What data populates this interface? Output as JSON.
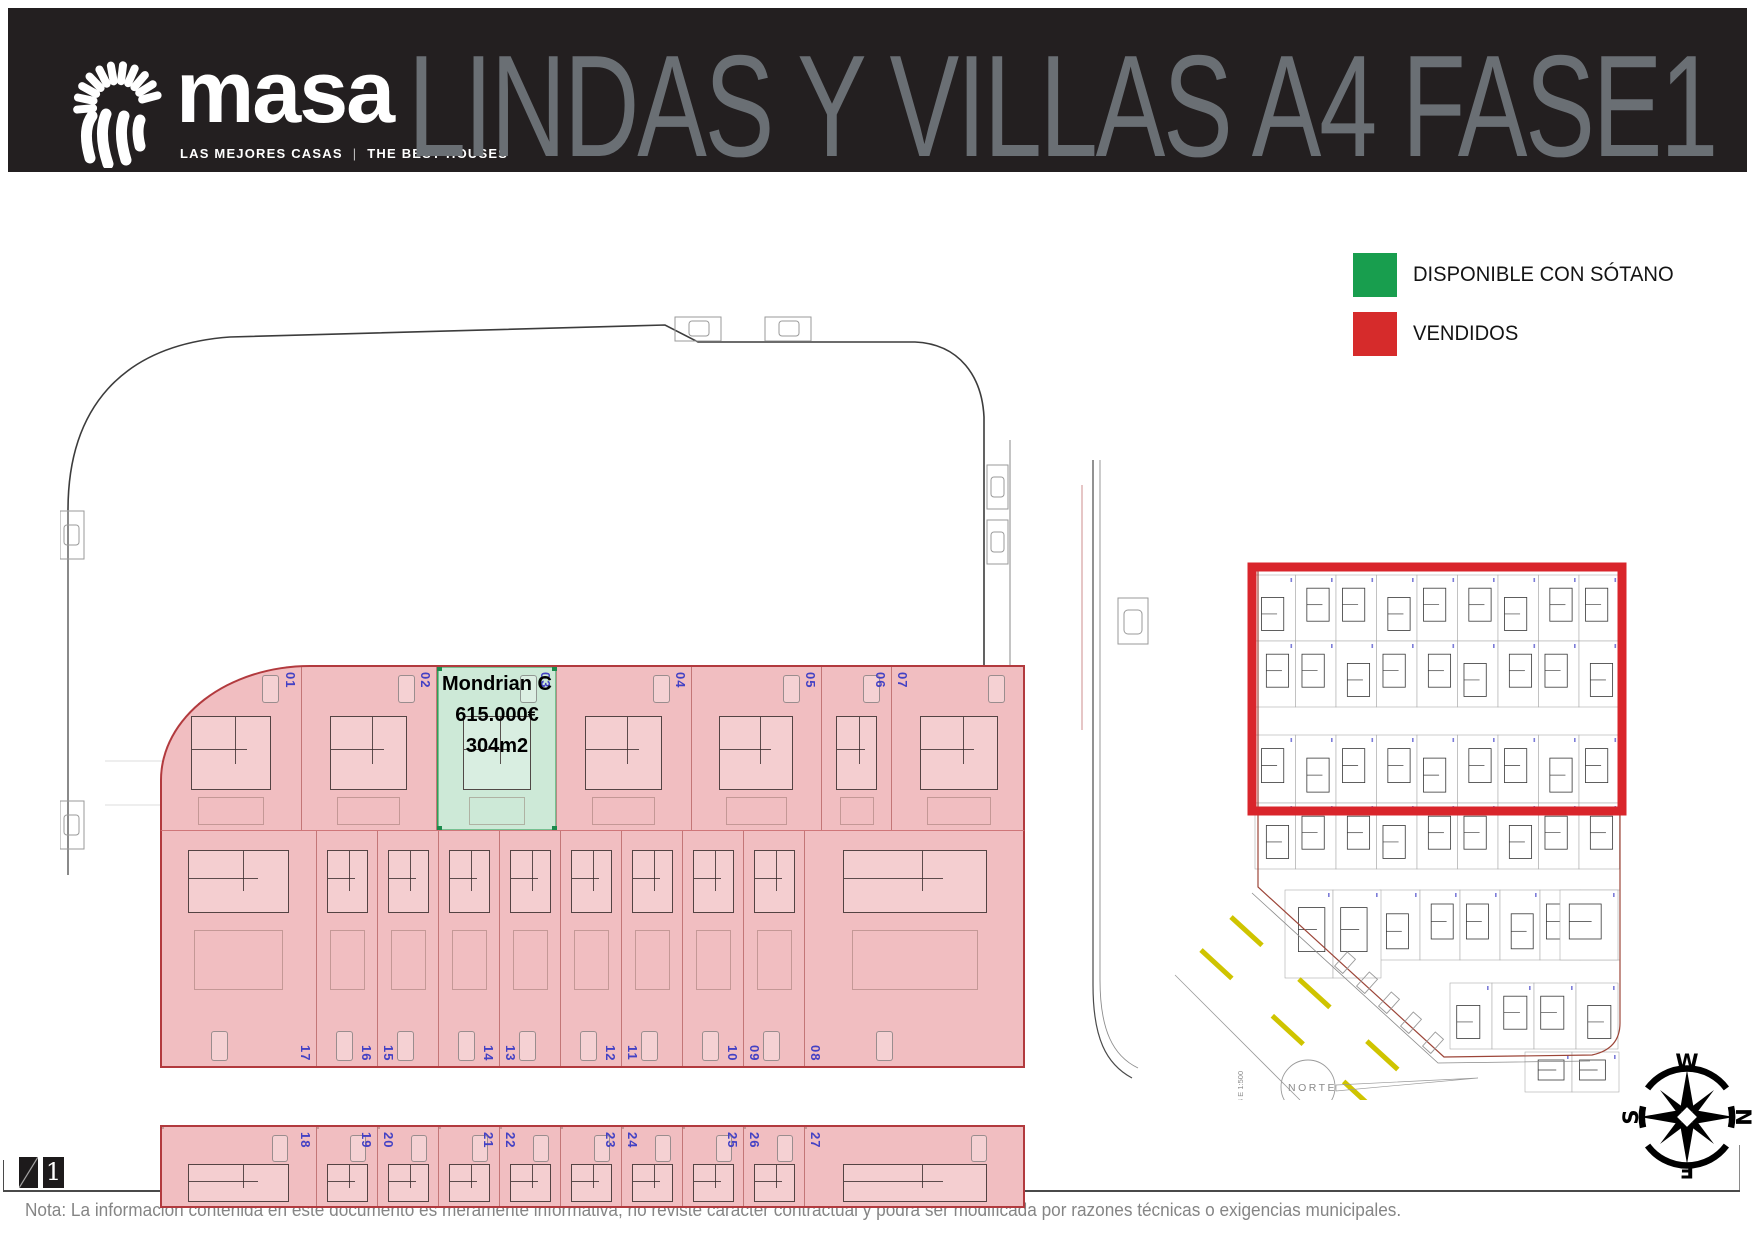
{
  "header": {
    "brand_name": "masa",
    "tagline_left": "LAS MEJORES CASAS",
    "tagline_sep": "|",
    "tagline_right": "THE BEST HOUSES",
    "title": "LINDAS Y VILLAS A4 FASE1"
  },
  "legend": {
    "items": [
      {
        "label": "DISPONIBLE CON SÓTANO",
        "color": "#189e4e"
      },
      {
        "label": "VENDIDOS",
        "color": "#d62b2b"
      }
    ]
  },
  "site_plan": {
    "available_plot": {
      "number": "03",
      "model": "Mondrian C",
      "price": "615.000€",
      "area": "304m2"
    },
    "rows": [
      {
        "plots": [
          {
            "number": "01",
            "status": "sold"
          },
          {
            "number": "02",
            "status": "sold"
          },
          {
            "number": "03",
            "status": "available"
          },
          {
            "number": "04",
            "status": "sold"
          },
          {
            "number": "05",
            "status": "sold"
          },
          {
            "number": "06",
            "status": "sold"
          },
          {
            "number": "07",
            "status": "sold"
          }
        ]
      },
      {
        "plots": [
          {
            "number": "17",
            "status": "sold"
          },
          {
            "number": "16",
            "status": "sold"
          },
          {
            "number": "15",
            "status": "sold"
          },
          {
            "number": "14",
            "status": "sold"
          },
          {
            "number": "13",
            "status": "sold"
          },
          {
            "number": "12",
            "status": "sold"
          },
          {
            "number": "11",
            "status": "sold"
          },
          {
            "number": "10",
            "status": "sold"
          },
          {
            "number": "09",
            "status": "sold"
          },
          {
            "number": "08",
            "status": "sold"
          }
        ]
      },
      {
        "plots": [
          {
            "number": "18",
            "status": "sold"
          },
          {
            "number": "19",
            "status": "sold"
          },
          {
            "number": "20",
            "status": "sold"
          },
          {
            "number": "21",
            "status": "sold"
          },
          {
            "number": "22",
            "status": "sold"
          },
          {
            "number": "23",
            "status": "sold"
          },
          {
            "number": "24",
            "status": "sold"
          },
          {
            "number": "25",
            "status": "sold"
          },
          {
            "number": "26",
            "status": "sold"
          },
          {
            "number": "27",
            "status": "sold"
          }
        ]
      }
    ],
    "colors": {
      "sold_fill": "#f1bec1",
      "available_fill": "#cde9d7",
      "band_border": "#b23a3e",
      "number_blue": "#4341c4"
    }
  },
  "minimap": {
    "norte_label": "NORTE",
    "scale_label": "A4 E 1:500",
    "red_outline_color": "#d9252b",
    "road_marking_color": "#cfc400"
  },
  "compass": {
    "top": "W",
    "right": "N",
    "bottom": "E",
    "left": "S"
  },
  "footer": {
    "page_number": "1",
    "note": "Nota: La información contenida en este documento es meramente informativa, no reviste carácter contractual y podrá ser modificada por razones técnicas o exigencias municipales."
  }
}
